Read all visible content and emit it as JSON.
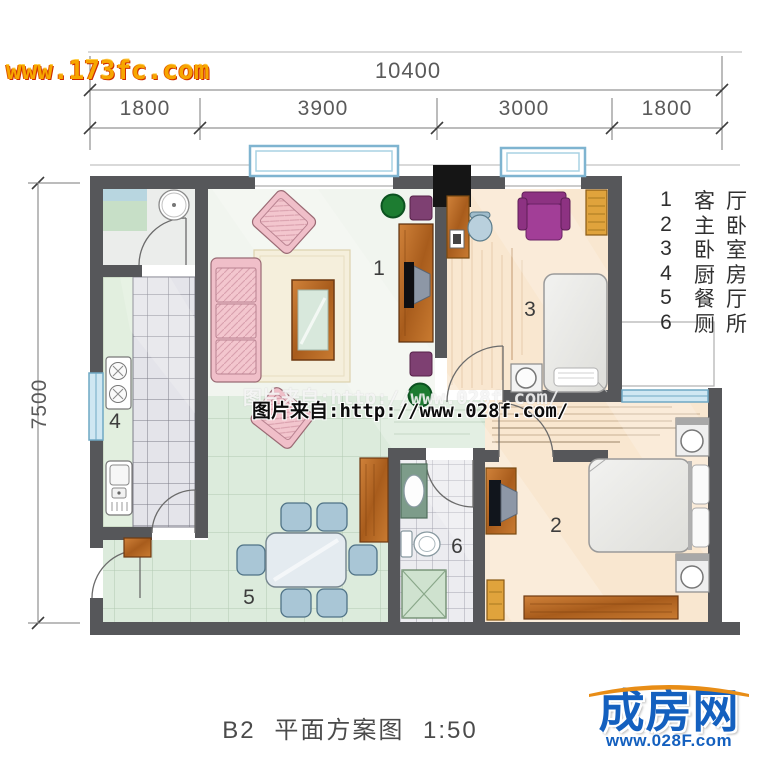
{
  "watermarks": {
    "site_top": "www.173fc.com",
    "credit": "图片来自:http://www.028f.com/"
  },
  "dimensions": {
    "top_total": "10400",
    "top_segments": [
      "1800",
      "3900",
      "3000",
      "1800"
    ],
    "left_total": "7500"
  },
  "rooms": [
    {
      "number": "1",
      "name": "客厅"
    },
    {
      "number": "2",
      "name": "主卧"
    },
    {
      "number": "3",
      "name": "卧室"
    },
    {
      "number": "4",
      "name": "厨房"
    },
    {
      "number": "5",
      "name": "餐厅"
    },
    {
      "number": "6",
      "name": "厕所"
    }
  ],
  "caption": "B2 平面方案图 1:50",
  "logo": {
    "name": "成房网",
    "url": "www.028F.com"
  },
  "colors": {
    "wall": "#56575a",
    "window_blue": "#cfe7f2",
    "window_frame": "#6fa8c4",
    "wood": "#b36a22",
    "mint_floor": "#dcebdc",
    "peach_floor": "#f9e7d0",
    "pink_sofa": "#f0bfc9",
    "purple_chair": "#a23e97",
    "plant_green": "#1d7c31",
    "logo_blue": "#1460bf",
    "logo_orange": "#e88d16",
    "watermark_orange": "#f7a600"
  }
}
